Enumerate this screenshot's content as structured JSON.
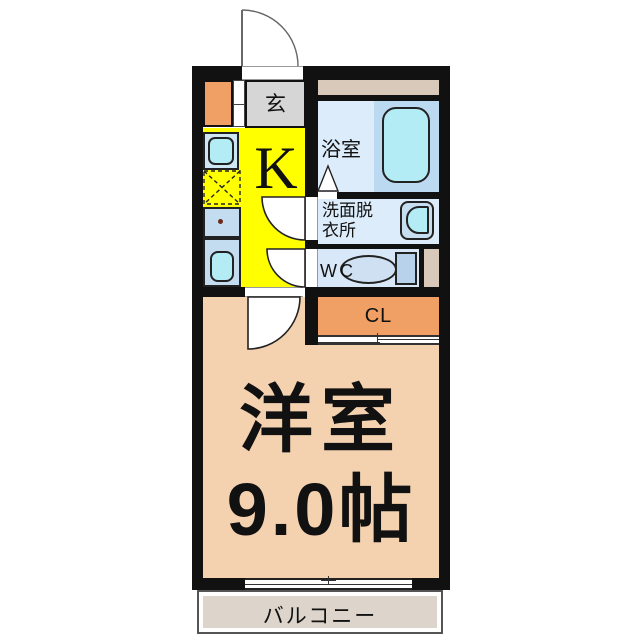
{
  "colors": {
    "wall": "#111111",
    "kitchen": "#ffff00",
    "entrance_hall": "#d6d6d6",
    "cabinet": "#f0a064",
    "closet": "#f0a064",
    "main_room": "#f4d2b0",
    "balcony": "#ddd5cb",
    "wet_floor": "#dcecfa",
    "wc_floor": "#d9e8f9",
    "tub_zone": "#bcd9f2",
    "fixture_fill": "#b4ecf6",
    "counter": "#c3dcf0",
    "basin_outer": "#c7ddf0",
    "toilet_bowl": "#cfe0f2",
    "toilet_tank": "#b9d2ec",
    "pipe_space": "#d9c9ba"
  },
  "labels": {
    "entrance": "玄",
    "kitchen": "K",
    "bathroom": "浴室",
    "washroom_line1": "洗面脱",
    "washroom_line2": "衣所",
    "toilet": "WC",
    "closet": "CL",
    "main_room_name": "洋室",
    "main_room_size": "9.0帖",
    "balcony": "バルコニー"
  },
  "fixtures": [
    "entrance-door-swing",
    "shoe-cabinet",
    "kitchen-sink",
    "refrigerator-space",
    "stove",
    "kitchen-counter-sink",
    "bathtub",
    "bathroom-door-marker",
    "washbasin",
    "toilet",
    "door-swing-washroom",
    "door-swing-wc",
    "door-swing-main-room",
    "closet-sliding-door",
    "balcony-sliding-window"
  ]
}
